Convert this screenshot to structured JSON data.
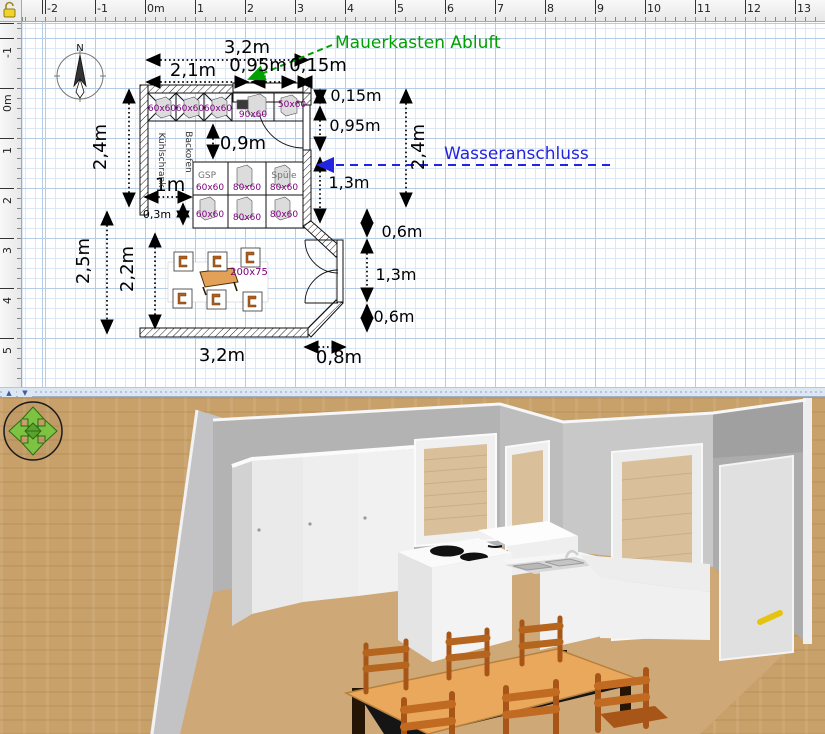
{
  "title": "Kitchen floor plan with 3D preview",
  "colors": {
    "accent_green": "#00a000",
    "accent_blue": "#2323e2",
    "furniture_label_purple": "#800080",
    "grid_blue": "#b5cce8",
    "floor_tan": "#c7a06a",
    "wall_grey": "#b3b3b3"
  },
  "plan": {
    "lock_icon": "open-padlock",
    "rulers": {
      "horizontal": [
        "-2",
        "-1",
        "0m",
        "1",
        "2",
        "3",
        "4",
        "5",
        "6",
        "7",
        "8",
        "9",
        "10",
        "11",
        "12",
        "13"
      ],
      "vertical": [
        "-1",
        "0m",
        "1",
        "2",
        "3",
        "4",
        "5"
      ]
    },
    "compass": {
      "label": "N"
    },
    "annotations": {
      "vent": {
        "text": "Mauerkasten Abluft",
        "color": "#00a000"
      },
      "water": {
        "text": "Wasseranschluss",
        "color": "#2323e2"
      }
    },
    "dimensions": [
      {
        "text": "3,2m"
      },
      {
        "text": "2,1m"
      },
      {
        "text": "0,95m"
      },
      {
        "text": "0,15m"
      },
      {
        "text": "0,15m"
      },
      {
        "text": "0,95m"
      },
      {
        "text": "1,3m"
      },
      {
        "text": "2,4m"
      },
      {
        "text": "0,6m"
      },
      {
        "text": "1,3m"
      },
      {
        "text": "0,6m"
      },
      {
        "text": "2,4m"
      },
      {
        "text": "2,5m"
      },
      {
        "text": "2,2m"
      },
      {
        "text": "1m"
      },
      {
        "text": "0,3m"
      },
      {
        "text": "3,2m"
      },
      {
        "text": "0,8m"
      },
      {
        "text": "0,9m"
      }
    ],
    "furniture_labels": [
      {
        "text": "60x60"
      },
      {
        "text": "60x60"
      },
      {
        "text": "60x60"
      },
      {
        "text": "90x60"
      },
      {
        "text": "50x60"
      },
      {
        "text": "GSP"
      },
      {
        "text": "60x60"
      },
      {
        "text": "80x60"
      },
      {
        "text": "Spüle"
      },
      {
        "text": "80x60"
      },
      {
        "text": "60x60"
      },
      {
        "text": "80x60"
      },
      {
        "text": "80x60"
      },
      {
        "text": "200x75"
      },
      {
        "text": "Kühlschrank"
      },
      {
        "text": "Backofen"
      }
    ]
  },
  "splitter": {
    "collapse_up": "▲",
    "collapse_down": "▼"
  },
  "view3d": {
    "nav_widget": [
      "up-arrow",
      "down-arrow",
      "left-arrow",
      "right-arrow",
      "center-diamond"
    ],
    "scene_objects": [
      "walls",
      "back-window",
      "side-window",
      "glass-door",
      "white-door",
      "tall-cabinets",
      "cooktop",
      "sink-counter",
      "dining-table",
      "six-chairs"
    ]
  }
}
